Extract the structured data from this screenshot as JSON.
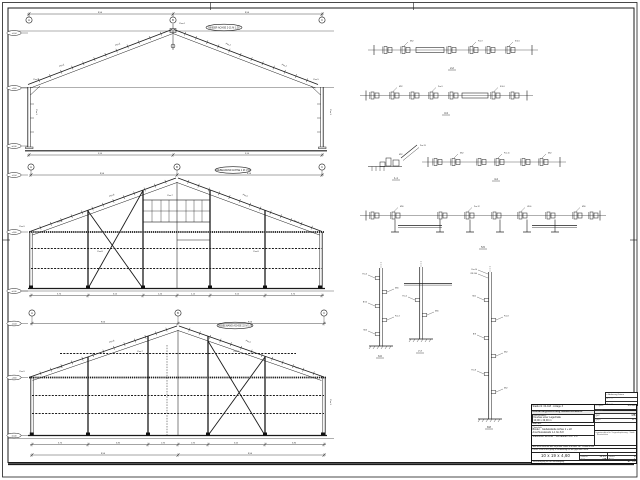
{
  "sheet": {
    "bg": "#ffffff",
    "line_color": "#1b1b1b",
    "fold_marks": "din-824"
  },
  "elevations": [
    {
      "name": "frame-section",
      "title": "BINDER ACHSE 2-21  M 1:50",
      "grid_y": 20,
      "dim_y": 14,
      "grids": [
        {
          "x": 29,
          "label": "A"
        },
        {
          "x": 173,
          "label": "B"
        },
        {
          "x": 322,
          "label": "C"
        }
      ],
      "dims_top": [
        {
          "x": 100,
          "t": "9,50"
        },
        {
          "x": 247,
          "t": "9,50"
        }
      ],
      "levels": [
        {
          "y": 33,
          "t": "+6,04"
        },
        {
          "y": 88,
          "t": "+4,60"
        },
        {
          "y": 146,
          "t": "±0,00"
        }
      ],
      "oval": {
        "x": 224,
        "y": 27.5
      },
      "ticks_bottom": [
        29,
        173,
        322
      ],
      "dims_bottom_y": 155,
      "dims_bottom": [
        {
          "x": 100,
          "t": "9,50"
        },
        {
          "x": 247,
          "t": "9,50"
        }
      ],
      "annotations": [
        {
          "x": 62,
          "y": 66,
          "t": "Pos.2",
          "r": -20
        },
        {
          "x": 118,
          "y": 45,
          "t": "Pos.2",
          "r": -20
        },
        {
          "x": 228,
          "y": 45,
          "t": "Pos.2",
          "r": 20
        },
        {
          "x": 284,
          "y": 66,
          "t": "Pos.2",
          "r": 20
        },
        {
          "x": 182,
          "y": 24,
          "t": "Pos.4",
          "r": 0
        },
        {
          "x": 36,
          "y": 80,
          "t": "Pos.5",
          "r": 0
        },
        {
          "x": 316,
          "y": 80,
          "t": "Pos.5",
          "r": 0
        },
        {
          "x": 36,
          "y": 112,
          "t": "Pos.1",
          "r": 90
        },
        {
          "x": 330,
          "y": 112,
          "t": "Pos.1",
          "r": 90
        }
      ]
    },
    {
      "name": "gable-wall-axis-1",
      "title": "GIEBELWAND ACHSE 1  M 1:50",
      "grid_y": 167,
      "dim_y": 175,
      "grids": [
        {
          "x": 31,
          "label": "A"
        },
        {
          "x": 177,
          "label": "B"
        },
        {
          "x": 322,
          "label": "C"
        }
      ],
      "dims_top": [
        {
          "x": 102,
          "t": "9,50"
        },
        {
          "x": 249,
          "t": "9,50"
        }
      ],
      "levels": [
        {
          "y": 175,
          "t": "+6,04"
        },
        {
          "y": 232,
          "t": "+4,60"
        },
        {
          "y": 291,
          "t": "±0,00"
        }
      ],
      "oval": {
        "x": 233,
        "y": 170
      },
      "ticks_bottom": [
        31,
        88,
        143,
        177,
        210,
        265,
        322
      ],
      "dims_bottom_y": 295.5,
      "dims_bottom": [
        {
          "x": 59,
          "t": "3,70"
        },
        {
          "x": 115,
          "t": "3,55"
        },
        {
          "x": 160,
          "t": "2,20"
        },
        {
          "x": 193,
          "t": "2,15"
        },
        {
          "x": 237,
          "t": "3,55"
        },
        {
          "x": 293,
          "t": "3,70"
        }
      ],
      "annotations": [
        {
          "x": 112,
          "y": 196,
          "t": "Pos.6",
          "r": -20
        },
        {
          "x": 245,
          "y": 196,
          "t": "Pos.6",
          "r": 20
        },
        {
          "x": 60,
          "y": 222,
          "t": "Pos.6",
          "r": -20
        },
        {
          "x": 296,
          "y": 222,
          "t": "Pos.6",
          "r": 20
        },
        {
          "x": 170,
          "y": 196,
          "t": "Pos.7",
          "r": 0
        },
        {
          "x": 100,
          "y": 252,
          "t": "Pos.8",
          "r": 0
        },
        {
          "x": 22,
          "y": 227,
          "t": "Pos.9",
          "r": 0
        },
        {
          "x": 256,
          "y": 252,
          "t": "Pos.8",
          "r": 0
        }
      ]
    },
    {
      "name": "gable-wall-axis-22",
      "title": "GIEBELWAND ACHSE 22  M 1:50",
      "grid_y": 313,
      "dim_y": 323.5,
      "grids": [
        {
          "x": 32,
          "label": "A"
        },
        {
          "x": 178,
          "label": "B"
        },
        {
          "x": 324,
          "label": "C"
        }
      ],
      "dims_top": [
        {
          "x": 103,
          "t": "9,50"
        },
        {
          "x": 250,
          "t": "9,50"
        }
      ],
      "levels": [
        {
          "y": 323.5,
          "t": "+6,04"
        },
        {
          "y": 377.5,
          "t": "+4,60"
        },
        {
          "y": 435.5,
          "t": "±0,00"
        }
      ],
      "oval": {
        "x": 235,
        "y": 325.5
      },
      "ticks_bottom": [
        32,
        88,
        148,
        178,
        208,
        265,
        324
      ],
      "dims_bottom_y": 444.5,
      "dims_bottom": [
        {
          "x": 60,
          "t": "3,70"
        },
        {
          "x": 118,
          "t": "3,85"
        },
        {
          "x": 163,
          "t": "1,95"
        },
        {
          "x": 193,
          "t": "1,95"
        },
        {
          "x": 236,
          "t": "3,65"
        },
        {
          "x": 294,
          "t": "3,80"
        }
      ],
      "dims_overall_y": 455,
      "ticks_overall": [
        32,
        178,
        324
      ],
      "dims_overall": [
        {
          "x": 103,
          "t": "9,50"
        },
        {
          "x": 250,
          "t": "9,50"
        }
      ],
      "annotations": [
        {
          "x": 112,
          "y": 342,
          "t": "Pos.6",
          "r": -20
        },
        {
          "x": 248,
          "y": 342,
          "t": "Pos.6",
          "r": 20
        },
        {
          "x": 60,
          "y": 368,
          "t": "Pos.6",
          "r": -20
        },
        {
          "x": 296,
          "y": 368,
          "t": "Pos.6",
          "r": 20
        },
        {
          "x": 236,
          "y": 352,
          "t": "Pos.8",
          "r": 0
        },
        {
          "x": 140,
          "y": 352,
          "t": "Pos.7",
          "r": 0
        },
        {
          "x": 22,
          "y": 372,
          "t": "Pos.9",
          "r": 0
        },
        {
          "x": 330,
          "y": 402,
          "t": "Pos.1",
          "r": 90
        }
      ]
    }
  ],
  "details": {
    "strips": [
      {
        "name": "purlin-splice-detail-2",
        "y": 50,
        "x": 374,
        "w": 158,
        "clusters": [
          10,
          28,
          74,
          96,
          113,
          133
        ],
        "bar": {
          "x": 42,
          "w": 28
        },
        "leader_texts": [
          "M12",
          "Pos.9",
          "Kl 4.6"
        ],
        "label": "2-2",
        "label_x": 452,
        "label_y": 69
      },
      {
        "name": "purlin-splice-detail-3",
        "y": 95.5,
        "x": 366,
        "w": 161,
        "clusters": [
          5,
          25,
          45,
          64,
          84,
          126,
          145
        ],
        "bar": {
          "x": 96,
          "w": 26
        },
        "leader_texts": [
          "M12",
          "Pos.9",
          "Kl 4.6"
        ],
        "label": "3-3",
        "label_x": 446,
        "label_y": 114
      },
      {
        "name": "girt-splice-detail-4",
        "y": 162,
        "x": 428,
        "w": 132,
        "clusters": [
          6,
          24,
          50,
          68,
          94,
          112
        ],
        "bar": null,
        "leader_texts": [
          "M12",
          "Pos.11"
        ],
        "label": "4-4",
        "label_x": 496,
        "label_y": 180
      },
      {
        "name": "eave-girt-detail-5",
        "y": 215.5,
        "x": 366,
        "w": 234,
        "clusters": [
          5,
          26,
          73,
          100,
          127,
          153,
          181,
          208,
          224
        ],
        "bar": null,
        "posts": [
          29,
          74,
          104,
          134,
          161,
          189
        ],
        "beams": [
          {
            "x": 32,
            "w": 44
          },
          {
            "x": 166,
            "w": 45
          }
        ],
        "leader_texts": [
          "M16",
          "Pos.12",
          "U100"
        ],
        "label": "5-5",
        "label_x": 483,
        "label_y": 248
      }
    ],
    "verticals": [
      {
        "name": "column-section-6",
        "x": 381,
        "y1": 268,
        "y2": 346,
        "cleats": [
          278,
          292,
          306,
          320,
          334
        ],
        "ground": true,
        "leader_texts": [
          "Pos.3",
          "M16",
          "Bl 10"
        ],
        "label": "6-6",
        "label_x": 380,
        "label_y": 357
      },
      {
        "name": "column-section-7",
        "x": 421,
        "y1": 267,
        "y2": 339,
        "beam_y": 283.5,
        "beam_x": 404,
        "beam_w": 48,
        "cleats": [
          300,
          315
        ],
        "ground": true,
        "leader_texts": [
          "Pos.5",
          "M16"
        ],
        "label": "7-7",
        "label_x": 420,
        "label_y": 352
      },
      {
        "name": "column-section-8",
        "x": 490,
        "y1": 272,
        "y2": 419,
        "cleats": [
          300,
          320,
          338,
          356,
          374,
          392
        ],
        "ground": true,
        "top_notes": [
          "Pos.10",
          "IPE 140"
        ],
        "leader_texts": [
          "M12",
          "Pos.8",
          "Bl 8",
          "M12",
          "Pos.8",
          "M12"
        ],
        "label": "8-8",
        "label_x": 489,
        "label_y": 428
      }
    ],
    "corner": {
      "name": "corner-detail-1",
      "label": "1-1",
      "label_x": 396,
      "label_y": 179,
      "leader_texts": [
        "Pos.13",
        "M12"
      ]
    }
  },
  "titleblock": {
    "revision_rows": [
      "c   Änderung      Datum",
      "b   —                —",
      "a   —                —"
    ],
    "header_left": "Statik-Nr. 04-118 · Anlage 3",
    "header_bar": "Ausführungszeichnung Stahlkonstruktion",
    "project_label": "Bauvorhaben:",
    "project_line1": "Neubau einer Lagerhalle",
    "project_line2": "10,00 x 19,00 m",
    "client_label": "Bauherr:",
    "content_label": "Planinhalt:",
    "content_line1": "Binder · Giebelwände Achse 1 + 22",
    "content_line2": "Anschlussdetails 1-1 bis 8-8",
    "inhalt_row": "Stahlsorte S235JR · Schrauben 4.6 / 5.6",
    "right_rows": [
      [
        "Projekt",
        "04-118"
      ],
      [
        "Datum",
        "12.05."
      ],
      [
        "gez.",
        "MB"
      ],
      [
        "gepr.",
        "KH"
      ]
    ],
    "address": "Ingenieurbüro für Tragwerksplanung · Statik · Konstruktion",
    "note_row1": "Alle Maße sind am Bau zu prüfen! Maße in m bzw. cm · Profile in mm",
    "note_row2": "Dieser Plan ist nur gültig in Verbindung mit der geprüften Statik",
    "stamp": "10 x 19 x 4,60",
    "mid_rows": [
      [
        "Maßstab",
        "1:50"
      ],
      [
        "Datum",
        "12.05."
      ],
      [
        "gez.",
        "MB"
      ]
    ],
    "corner_rows": [
      [
        "Plan-Nr.",
        "S-03"
      ],
      [
        "Index",
        "a"
      ],
      [
        "Blatt",
        "1"
      ]
    ],
    "footer_left": "Vervielfältigung nur mit Genehmigung",
    "footer_right": "A1 · 1:50"
  }
}
